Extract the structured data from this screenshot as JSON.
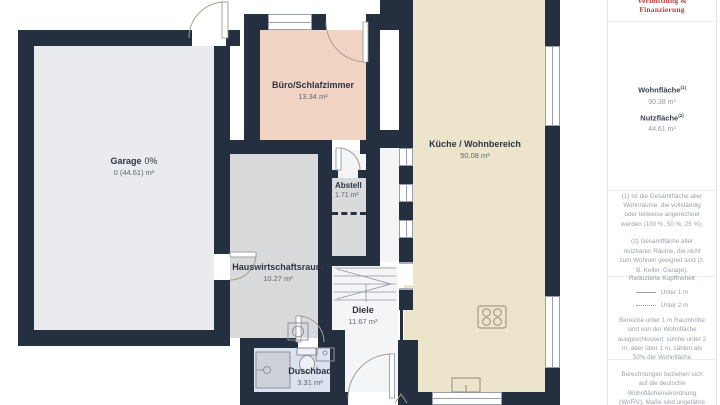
{
  "rooms": {
    "garage": {
      "name": "Garage",
      "pct": "0%",
      "area": "0 (44.61) m²"
    },
    "buero": {
      "name": "Büro/Schlafzimmer",
      "area": "13.34 m²"
    },
    "kueche": {
      "name": "Küche / Wohnbereich",
      "area": "50.08 m²"
    },
    "abstell": {
      "name": "Abstell",
      "area": "1.71 m²"
    },
    "hwr": {
      "name": "Hauswirtschaftsraum",
      "area": "10.27 m²"
    },
    "diele": {
      "name": "Diele",
      "area": "11.67 m²"
    },
    "duschbad": {
      "name": "Duschbad",
      "area": "3.31 m²"
    }
  },
  "sidebar": {
    "brand": "Vermittlung & Finanzierung",
    "wohnflaeche": {
      "label": "Wohnfläche",
      "sup": "(1)",
      "value": "90.38 m²"
    },
    "nutzflaeche": {
      "label": "Nutzfläche",
      "sup": "(2)",
      "value": "44.61 m²"
    },
    "footnote1": "(1) Ist die Gesamtfläche aller Wohnräume, die vollständig oder teilweise angerechnet werden (100 %, 50 %, 25 %).",
    "footnote2": "(2) Gesamtfläche aller nutzbaren Räume, die nicht zum Wohnen geeignet sind (z. B. Keller, Garage).",
    "kopffreiheit": {
      "title": "Reduzierte Kopffreiheit",
      "under1": "Unter 1 m",
      "under2": "Unter 2 m",
      "note": "Bereiche unter 1 m Raumhöhe sind von der Wohnfläche ausgeschlossen; solche unter 2 m, aber über 1 m, zählen als 50% der Wohnfläche"
    },
    "disclaimer": "Berechnungen beziehen sich auf die deutsche Wohnflächenverordnung (WoFlV). Maße sind ungefähre Angaben"
  },
  "colors": {
    "wall": "#243040",
    "garage_floor": "#e9ebee",
    "utility_floor": "#d9dadc",
    "office_floor": "#f2d4c5",
    "kitchen_floor": "#ece4cb",
    "hall_floor": "#f4f5f7",
    "bath_floor": "#dce2ee",
    "accent_red": "#b5403c"
  }
}
